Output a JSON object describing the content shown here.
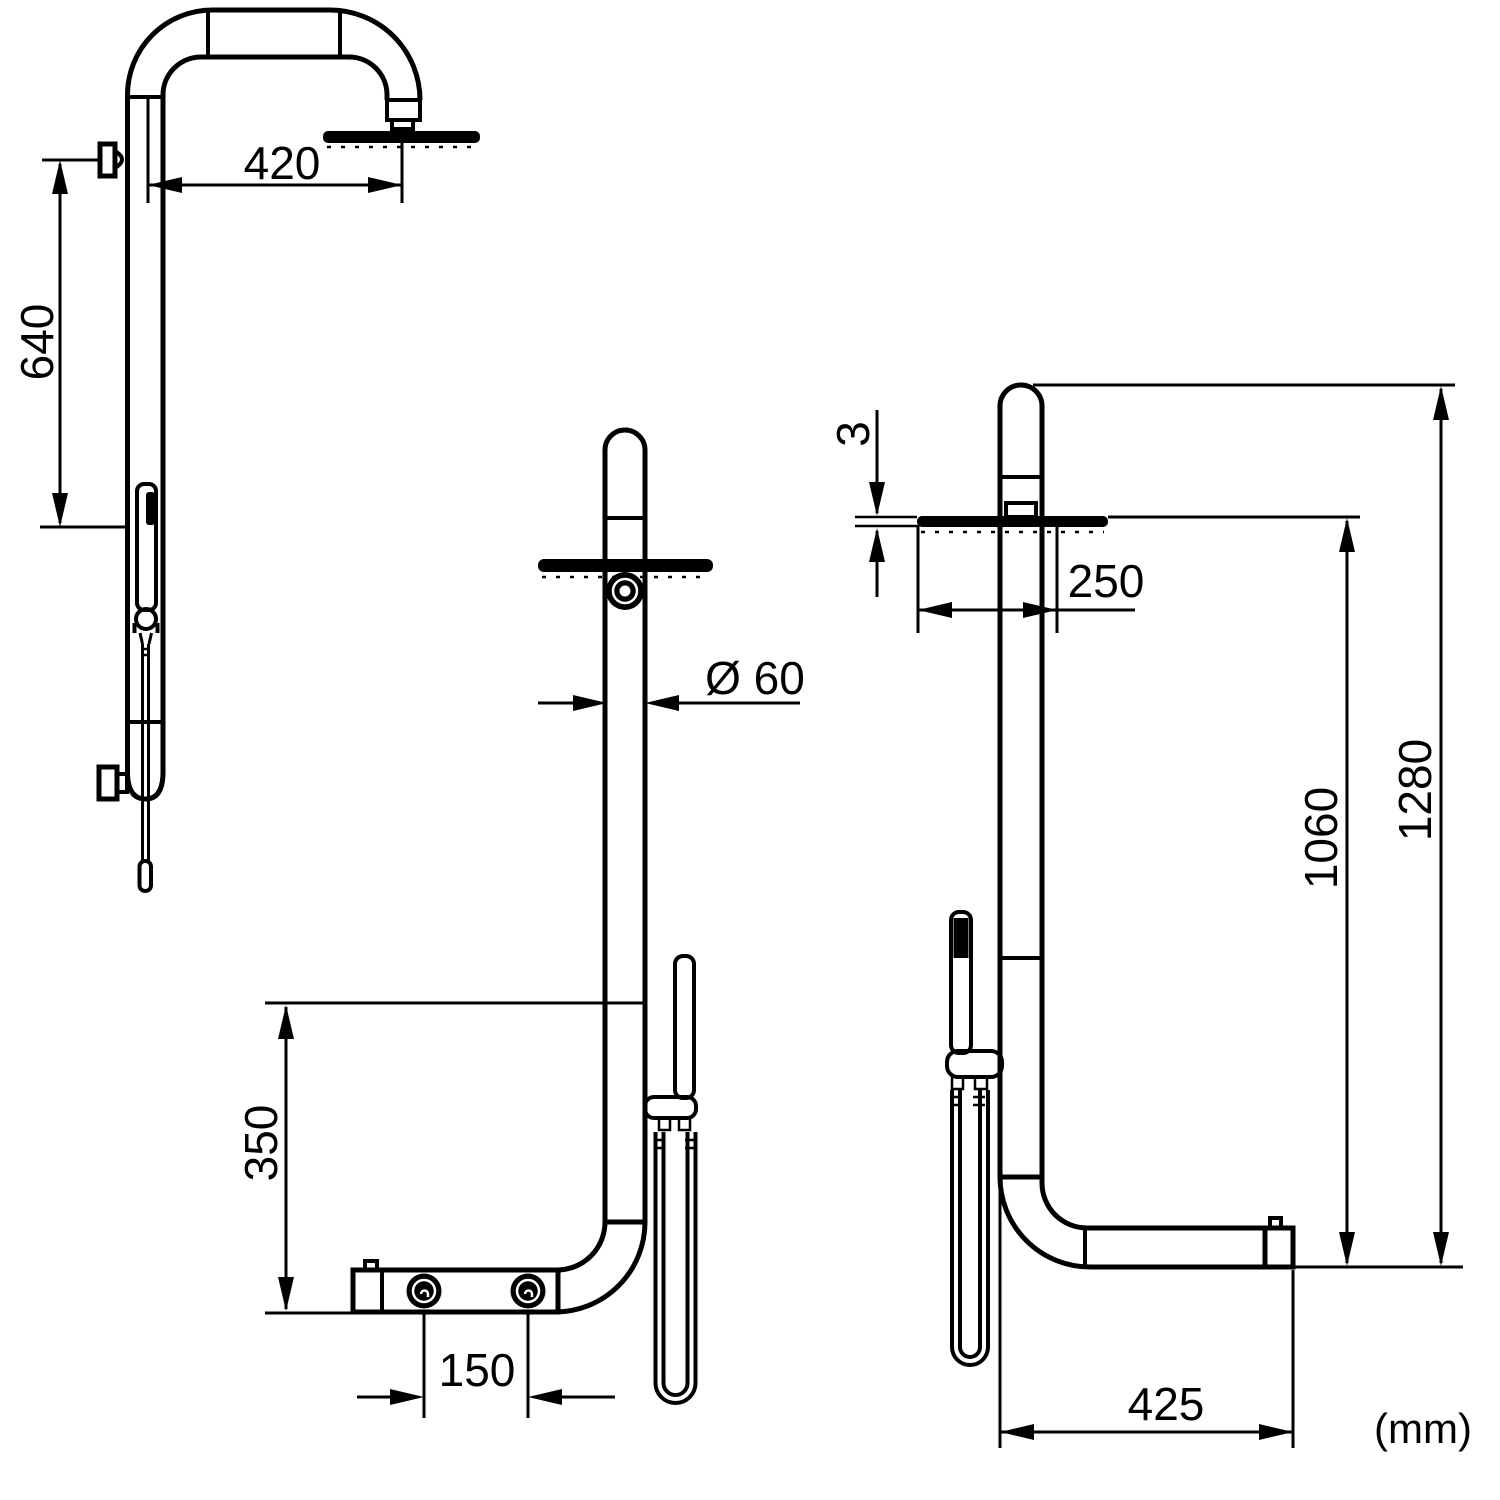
{
  "drawing": {
    "type": "technical-dimension-drawing",
    "subject": "shower-column",
    "unit_note": "(mm)",
    "line_color": "#000000",
    "background_color": "#ffffff",
    "views": {
      "left_side": {
        "dims": {
          "arm_reach": "420",
          "head_to_hand_shower": "640"
        }
      },
      "front": {
        "dims": {
          "pole_diameter": "Ø 60",
          "hand_shower_drop": "350",
          "valve_spacing": "150"
        }
      },
      "right_side": {
        "dims": {
          "head_thickness": "3",
          "head_diameter": "250",
          "head_height": "1060",
          "total_height": "1280",
          "base_depth": "425"
        }
      }
    },
    "dimensions_mm": {
      "arm_reach": 420,
      "head_to_hand_shower": 640,
      "pole_diameter": 60,
      "hand_shower_drop": 350,
      "valve_spacing": 150,
      "head_thickness": 3,
      "head_diameter": 250,
      "head_height": 1060,
      "total_height": 1280,
      "base_depth": 425
    }
  }
}
